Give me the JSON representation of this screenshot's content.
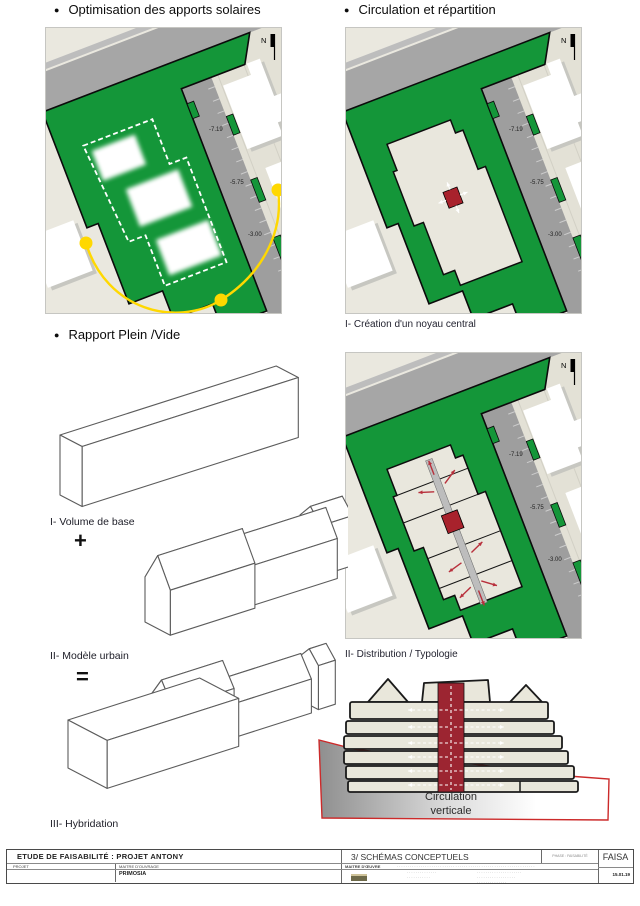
{
  "sections": {
    "solar": {
      "bullet": "●",
      "title": "Optimisation des apports solaires"
    },
    "circulation": {
      "bullet": "●",
      "title": "Circulation et répartition",
      "caption_noyau": "I- Création d'un noyau central",
      "caption_distribution": "II- Distribution  / Typologie"
    },
    "massing": {
      "bullet": "●",
      "title": "Rapport Plein /Vide",
      "label_volume": "I- Volume de base",
      "op_plus": "+",
      "label_urbain": "II- Modèle urbain",
      "op_equals": "=",
      "label_hybridation": "III- Hybridation"
    },
    "section": {
      "caption_line1": "Circulation",
      "caption_line2": "verticale"
    }
  },
  "plan_labels": {
    "north": "N",
    "levels": [
      "-7.19",
      "-5.75",
      "-3.00"
    ]
  },
  "colors": {
    "green": "#149639",
    "road": "#a6a6a6",
    "inner_road": "#9e9e9e",
    "site_bg": "#eae8df",
    "parcel": "#e3e1d6",
    "footprint": "#e9e7dd",
    "core_red": "#a8222c",
    "arrow_red": "#b8303c",
    "sun_yellow": "#ffd800",
    "section_red_band": "#9c2531",
    "ground_outline": "#cc2a2a",
    "floor_beige": "#e9e7db"
  },
  "titleblock": {
    "project_title": "ETUDE DE FAISABILITÉ : PROJET ANTONY",
    "project_label": "PROJET",
    "client_label": "MAITRE D'OUVRAGE",
    "client_name": "PRIMOSIA",
    "sheet_title": "3/ SCHÉMAS CONCEPTUELS",
    "architect_label": "MAITRE D'ŒUVRE",
    "phase_label": "PHASE : FAISABILITÉ",
    "code": "FAISA",
    "date": "15.01.19",
    "micro_row": "································································",
    "micro_a1": "··············",
    "micro_a2": "···········",
    "micro_b1": "·····················",
    "micro_b2": "··················",
    "micro_b3": "··············"
  }
}
